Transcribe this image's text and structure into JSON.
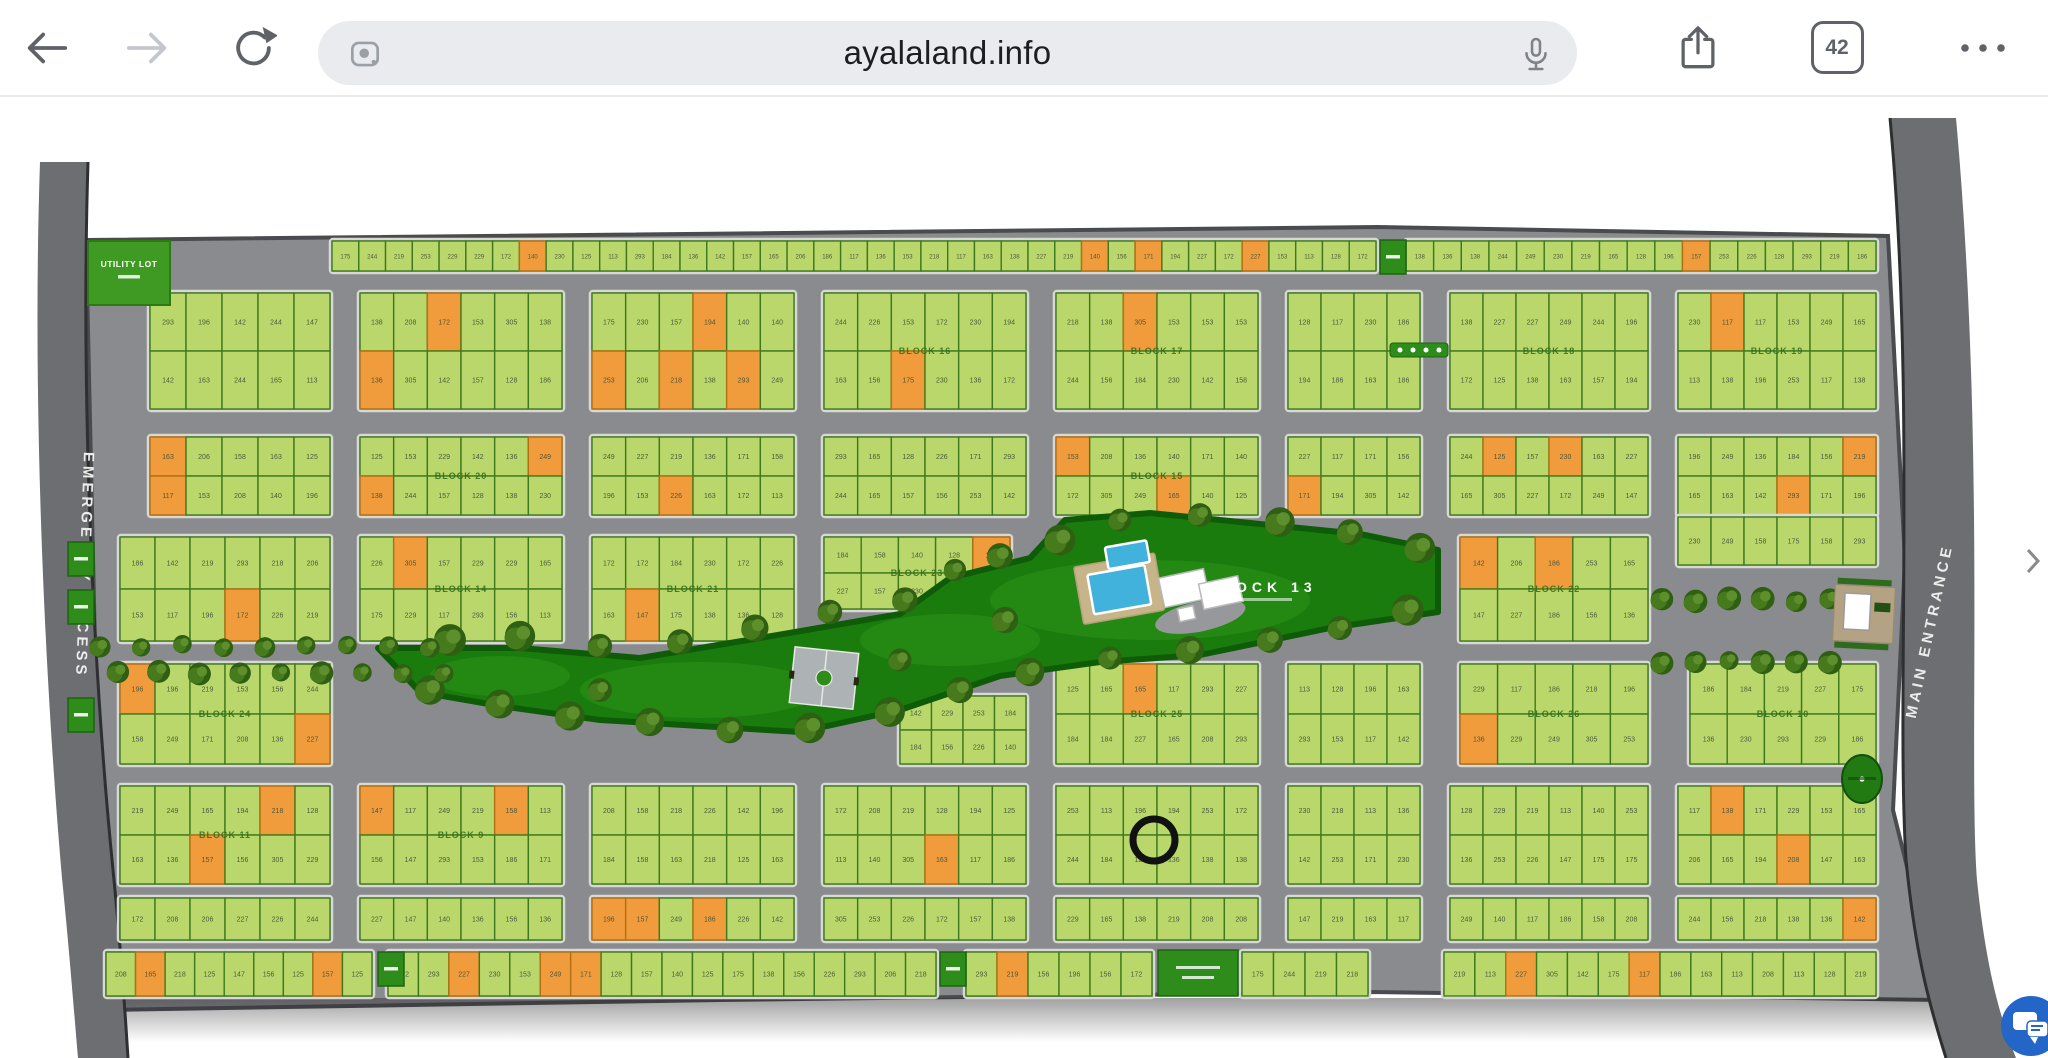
{
  "browser": {
    "url": "ayalaland.info",
    "tab_count": "42"
  },
  "map": {
    "labels": {
      "emergency_access": "EMERGENCY ACCESS",
      "main_entrance": "MAIN ENTRANCE",
      "block_13": "BLOCK 13",
      "utility_lot": "UTILITY LOT"
    },
    "colors": {
      "lot_green": "#b9d76a",
      "lot_green_stroke": "#3e7a1d",
      "lot_orange": "#f09c3c",
      "lot_orange_stroke": "#b06f10",
      "road": "#8a8b8f",
      "side_road": "#6d6e71",
      "park": "#1b7c0e",
      "park_edge": "#0e5c08",
      "tree_dark": "#2e5f12",
      "tree_mid": "#477a1c",
      "tree_light": "#5d8f2c",
      "marker_green": "#2e8c1b",
      "utility_green": "#3f9a23",
      "pool": "#41b2dc",
      "deck": "#c8b489",
      "ring": "#111111",
      "block_outline": "#d8d8d4"
    },
    "orange_ratio": 0.085,
    "lot_number_pool": [
      125,
      128,
      138,
      147,
      158,
      165,
      172,
      175,
      206,
      219,
      227,
      230,
      293,
      142,
      157,
      184,
      196,
      117,
      305,
      249,
      229,
      153,
      186,
      113,
      136,
      140,
      156,
      163,
      171,
      194,
      208,
      218,
      226,
      244,
      253
    ],
    "block_labels": [
      "BLOCK 16",
      "BLOCK 17",
      "BLOCK 18",
      "BLOCK 19",
      "BLOCK 20",
      "BLOCK 15",
      "BLOCK 14",
      "BLOCK 21",
      "BLOCK 22",
      "BLOCK 23",
      "BLOCK 24",
      "BLOCK 25",
      "BLOCK 26",
      "BLOCK 10",
      "BLOCK 11",
      "BLOCK 9",
      "BLOCK 8",
      "BLOCK 7",
      "BLOCK 6",
      "BLOCK 5",
      "BLOCK 4",
      "BLOCK 3",
      "BLOCK 2",
      "BLOCK 1",
      "BLOCK 12"
    ],
    "bands": [
      {
        "y": 241,
        "h": 30,
        "rows": 1,
        "lw": 27,
        "segs": [
          [
            332,
            1376
          ],
          [
            1406,
            1876
          ]
        ]
      },
      {
        "y": 293,
        "h": 116,
        "rows": 2,
        "lw": 36,
        "segs": [
          [
            150,
            330
          ],
          [
            360,
            562
          ],
          [
            592,
            794
          ],
          [
            824,
            1026
          ],
          [
            1056,
            1258
          ],
          [
            1288,
            1420
          ],
          [
            1450,
            1648
          ],
          [
            1678,
            1876
          ]
        ]
      },
      {
        "y": 437,
        "h": 78,
        "rows": 2,
        "lw": 34,
        "segs": [
          [
            150,
            330
          ],
          [
            360,
            562
          ],
          [
            592,
            794
          ],
          [
            824,
            1026
          ],
          [
            1056,
            1258
          ],
          [
            1288,
            1420
          ],
          [
            1450,
            1648
          ],
          [
            1678,
            1876
          ]
        ]
      },
      {
        "y": 537,
        "h": 104,
        "rows": 2,
        "lw": 36,
        "segs": [
          [
            120,
            330
          ],
          [
            360,
            562
          ],
          [
            592,
            794
          ],
          [
            1460,
            1648
          ]
        ]
      },
      {
        "y": 537,
        "h": 72,
        "rows": 2,
        "lw": 36,
        "segs": [
          [
            824,
            1010
          ]
        ]
      },
      {
        "y": 517,
        "h": 48,
        "rows": 1,
        "lw": 34,
        "segs": [
          [
            1678,
            1876
          ]
        ]
      },
      {
        "y": 696,
        "h": 68,
        "rows": 2,
        "lw": 36,
        "segs": [
          [
            900,
            1026
          ]
        ]
      },
      {
        "y": 664,
        "h": 100,
        "rows": 2,
        "lw": 36,
        "segs": [
          [
            120,
            330
          ],
          [
            1056,
            1258
          ],
          [
            1288,
            1420
          ],
          [
            1460,
            1648
          ],
          [
            1690,
            1876
          ]
        ]
      },
      {
        "y": 786,
        "h": 98,
        "rows": 2,
        "lw": 36,
        "segs": [
          [
            120,
            330
          ],
          [
            360,
            562
          ],
          [
            592,
            794
          ],
          [
            824,
            1026
          ],
          [
            1056,
            1258
          ],
          [
            1288,
            1420
          ],
          [
            1450,
            1648
          ],
          [
            1678,
            1876
          ]
        ]
      },
      {
        "y": 898,
        "h": 42,
        "rows": 1,
        "lw": 34,
        "segs": [
          [
            120,
            330
          ],
          [
            360,
            562
          ],
          [
            592,
            794
          ],
          [
            824,
            1026
          ],
          [
            1056,
            1258
          ],
          [
            1288,
            1420
          ],
          [
            1450,
            1648
          ],
          [
            1678,
            1876
          ]
        ]
      },
      {
        "y": 952,
        "h": 44,
        "rows": 1,
        "lw": 30,
        "segs": [
          [
            106,
            372
          ],
          [
            388,
            936
          ],
          [
            966,
            1152
          ],
          [
            1242,
            1368
          ],
          [
            1444,
            1876
          ]
        ]
      }
    ],
    "park_polygon": "378,648 520,648 640,658 760,638 900,614 950,578 1030,558 1065,520 1150,513 1250,523 1360,534 1438,550 1438,612 1330,628 1200,655 1100,662 1000,676 900,710 800,732 700,726 600,720 500,706 420,692",
    "park_trees": [
      [
        450,
        640
      ],
      [
        520,
        636
      ],
      [
        600,
        646
      ],
      [
        680,
        642
      ],
      [
        755,
        628
      ],
      [
        830,
        612
      ],
      [
        905,
        600
      ],
      [
        955,
        570
      ],
      [
        1000,
        556
      ],
      [
        1060,
        540
      ],
      [
        1120,
        520
      ],
      [
        1200,
        515
      ],
      [
        1280,
        522
      ],
      [
        1350,
        532
      ],
      [
        1420,
        548
      ],
      [
        430,
        690
      ],
      [
        500,
        704
      ],
      [
        570,
        716
      ],
      [
        650,
        722
      ],
      [
        730,
        730
      ],
      [
        810,
        728
      ],
      [
        890,
        712
      ],
      [
        960,
        690
      ],
      [
        1030,
        672
      ],
      [
        1110,
        658
      ],
      [
        1190,
        650
      ],
      [
        1270,
        640
      ],
      [
        1340,
        628
      ],
      [
        1408,
        610
      ],
      [
        600,
        690
      ],
      [
        900,
        660
      ],
      [
        1005,
        620
      ]
    ],
    "tree_rows": [
      {
        "y": 646,
        "x0": 100,
        "x1": 430,
        "n": 9
      },
      {
        "y": 672,
        "x0": 118,
        "x1": 444,
        "n": 9
      },
      {
        "y": 600,
        "x0": 1662,
        "x1": 1830,
        "n": 6
      },
      {
        "y": 662,
        "x0": 1662,
        "x1": 1830,
        "n": 6
      }
    ],
    "markers": [
      {
        "x": 68,
        "y": 542
      },
      {
        "x": 68,
        "y": 590
      },
      {
        "x": 68,
        "y": 698
      },
      {
        "x": 1380,
        "y": 240
      },
      {
        "x": 378,
        "y": 952
      },
      {
        "x": 940,
        "y": 952
      }
    ],
    "features": {
      "utility": {
        "x": 88,
        "y": 241,
        "w": 82,
        "h": 64
      },
      "pool_deck": {
        "x": 1078,
        "y": 560,
        "w": 82,
        "h": 58
      },
      "pool_big": {
        "x": 1090,
        "y": 570,
        "w": 58,
        "h": 40
      },
      "pool_small": {
        "x": 1112,
        "y": 546,
        "w": 42,
        "h": 22
      },
      "clubhouse": [
        {
          "x": 1162,
          "y": 572,
          "w": 46,
          "h": 30
        },
        {
          "x": 1200,
          "y": 586,
          "w": 40,
          "h": 26
        },
        {
          "x": 1174,
          "y": 606,
          "w": 16,
          "h": 13
        }
      ],
      "court": {
        "x": 792,
        "y": 650,
        "w": 64,
        "h": 56
      },
      "gate": {
        "x": 1834,
        "y": 586,
        "w": 60,
        "h": 56
      },
      "oval": {
        "cx": 1862,
        "cy": 779,
        "rx": 20,
        "ry": 24
      },
      "dots_bar": {
        "x": 1390,
        "y": 343,
        "w": 58,
        "h": 14
      },
      "big_block": {
        "x": 1158,
        "y": 950,
        "w": 80,
        "h": 46
      },
      "block13_label_pos": {
        "x": 1262,
        "y": 592
      }
    },
    "ring": {
      "cx": 1154,
      "cy": 840,
      "r": 21
    }
  },
  "chat": {
    "color": "#2465c8"
  }
}
